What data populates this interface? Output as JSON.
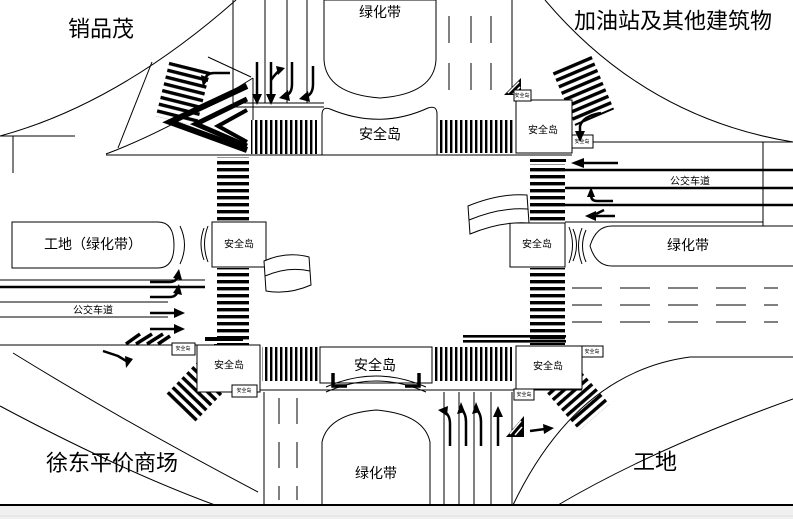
{
  "colors": {
    "ink": "#000000",
    "paper": "#ffffff",
    "footer_strip": "#f0f0f0"
  },
  "corner_labels": {
    "top_left": "销品茂",
    "top_right": "加油站及其他建筑物",
    "bottom_left": "徐东平价商场",
    "bottom_right": "工地"
  },
  "labels": {
    "green_belt": "绿化带",
    "safety_island": "安全岛",
    "bus_lane": "公交车道",
    "west_median": "工地（绿化带）",
    "mini": "安全岛"
  }
}
